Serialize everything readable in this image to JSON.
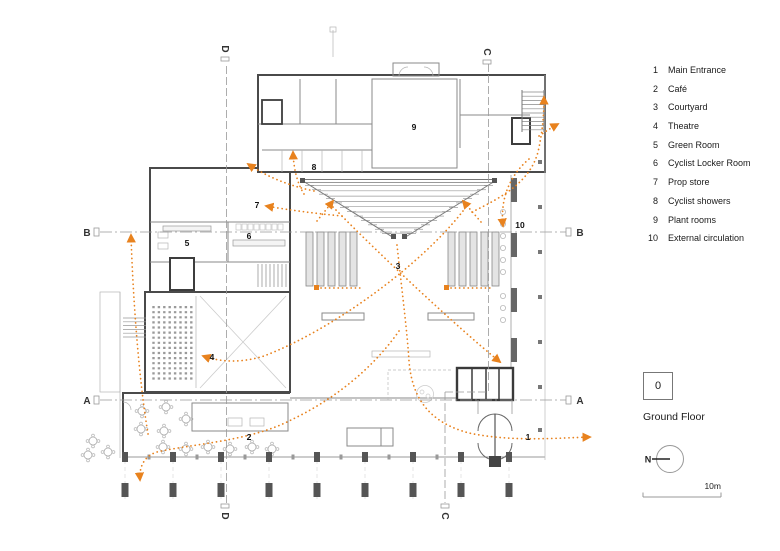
{
  "legend": {
    "items": [
      {
        "num": "1",
        "label": "Main Entrance"
      },
      {
        "num": "2",
        "label": "Café"
      },
      {
        "num": "3",
        "label": "Courtyard"
      },
      {
        "num": "4",
        "label": "Theatre"
      },
      {
        "num": "5",
        "label": "Green Room"
      },
      {
        "num": "6",
        "label": "Cyclist Locker Room"
      },
      {
        "num": "7",
        "label": "Prop store"
      },
      {
        "num": "8",
        "label": "Cyclist showers"
      },
      {
        "num": "9",
        "label": "Plant rooms"
      },
      {
        "num": "10",
        "label": "External circulation"
      }
    ]
  },
  "floor_badge": {
    "number": "0",
    "label": "Ground Floor"
  },
  "compass": {
    "label": "N"
  },
  "scale_bar": {
    "label": "10m"
  },
  "section_markers": {
    "a": "A",
    "b": "B",
    "c": "C",
    "d": "D"
  },
  "plan_labels": {
    "main_entrance": "1",
    "cafe": "2",
    "courtyard": "3",
    "theatre": "4",
    "green_room": "5",
    "locker_room": "6",
    "prop_store": "7",
    "showers": "8",
    "plant_rooms": "9",
    "external_circulation": "10"
  },
  "colors": {
    "circulation": "#e8821e",
    "wall_dark": "#4a4a4a"
  }
}
